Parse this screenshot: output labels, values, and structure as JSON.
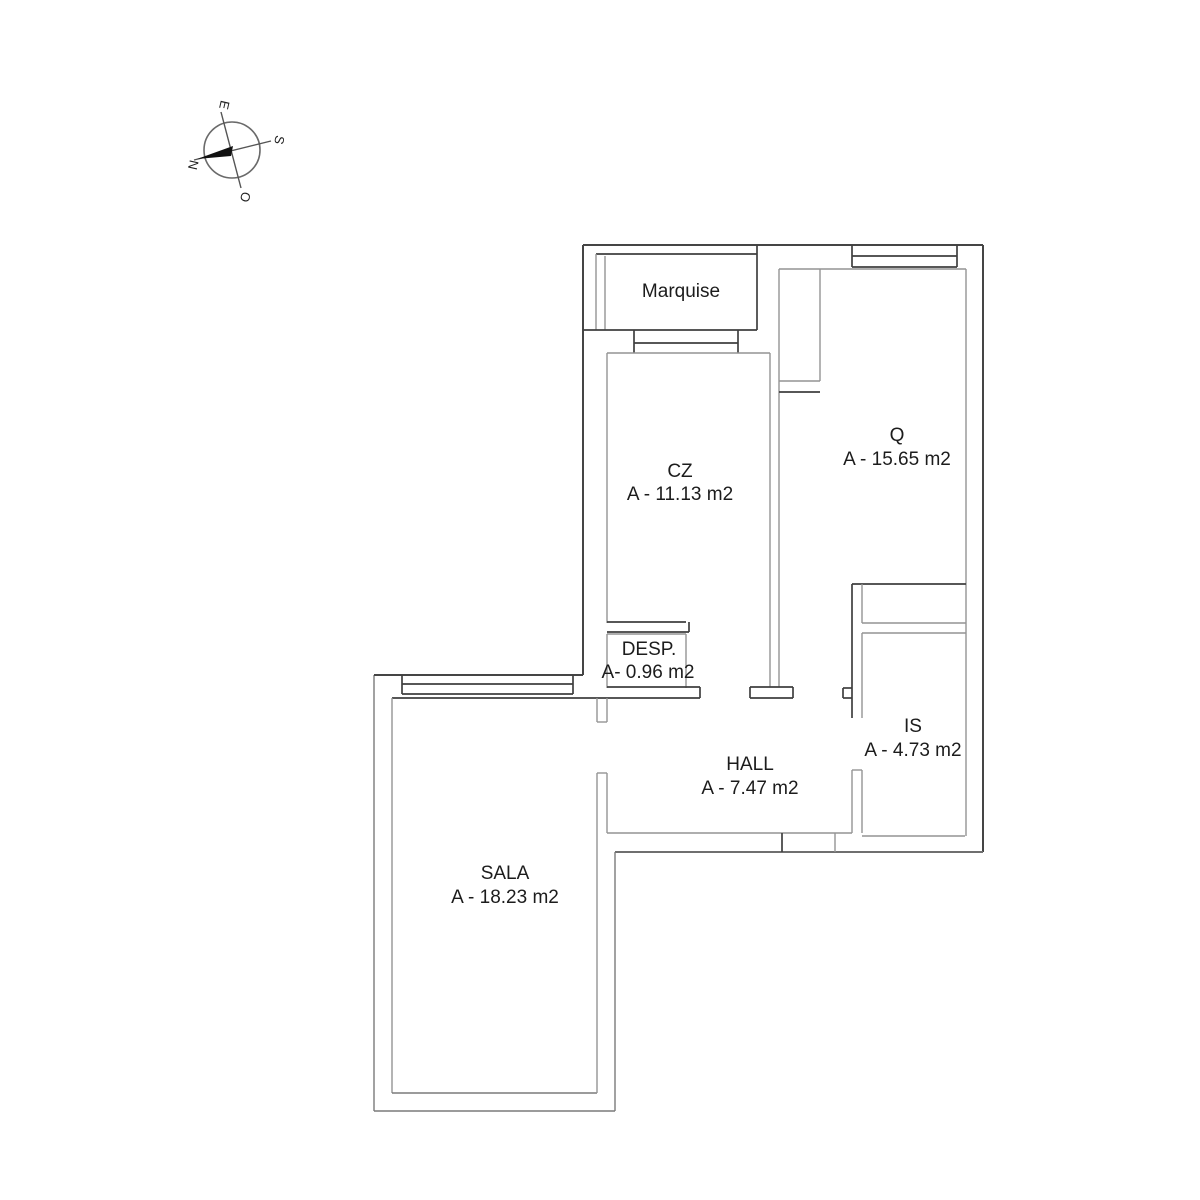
{
  "compass": {
    "north": "N",
    "east": "E",
    "south": "S",
    "west": "O"
  },
  "rooms": [
    {
      "id": "marquise",
      "name": "Marquise",
      "area": ""
    },
    {
      "id": "cz",
      "name": "CZ",
      "area": "A - 11.13 m2"
    },
    {
      "id": "q",
      "name": "Q",
      "area": "A - 15.65 m2"
    },
    {
      "id": "desp",
      "name": "DESP.",
      "area": "A- 0.96 m2"
    },
    {
      "id": "is",
      "name": "IS",
      "area": "A - 4.73 m2"
    },
    {
      "id": "hall",
      "name": "HALL",
      "area": "A - 7.47 m2"
    },
    {
      "id": "sala",
      "name": "SALA",
      "area": "A - 18.23 m2"
    }
  ],
  "colors": {
    "wall_dark": "#3f3f3f",
    "wall_gray": "#949494",
    "needle": "#111111",
    "background": "#ffffff"
  }
}
